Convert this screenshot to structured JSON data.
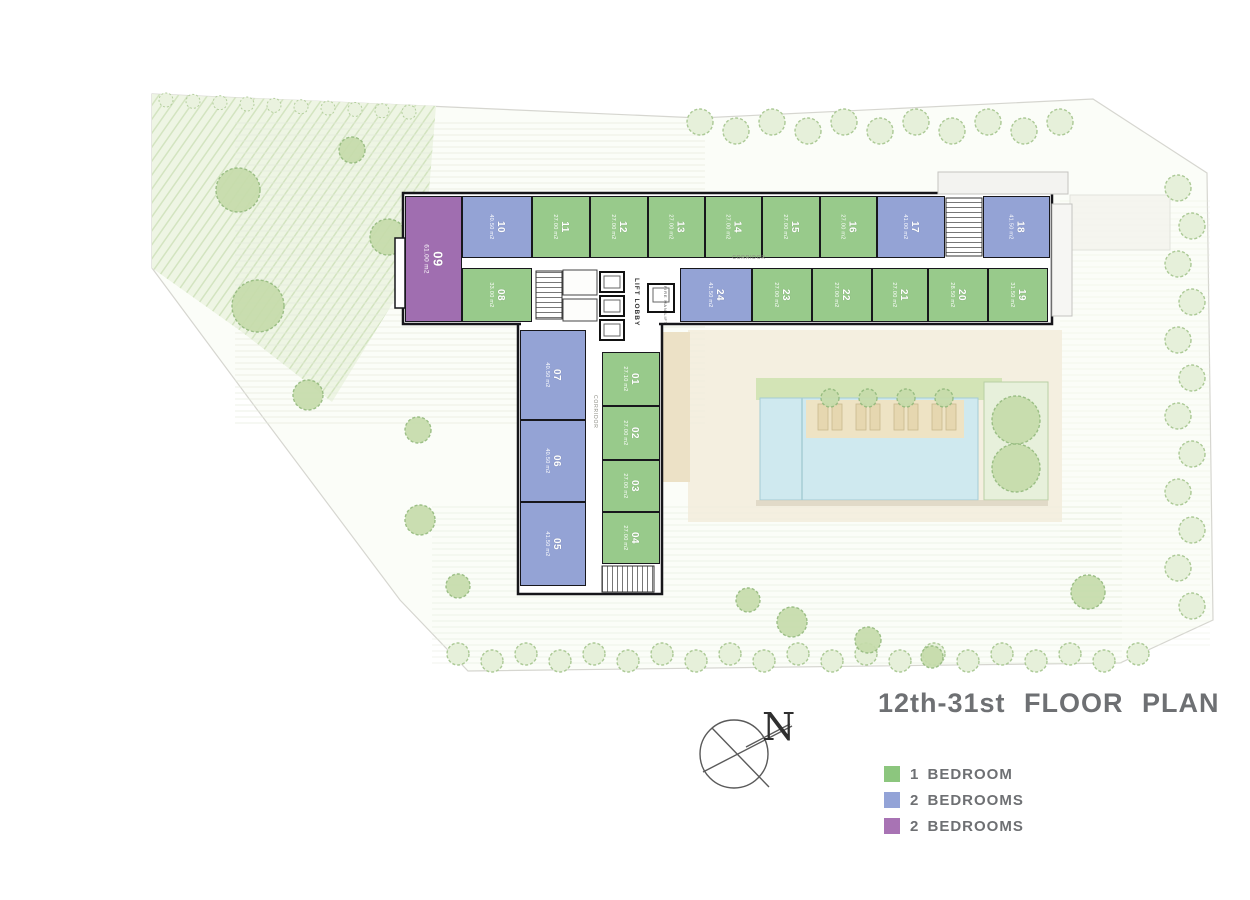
{
  "title": "12th-31st FLOOR PLAN",
  "compass": {
    "label": "N"
  },
  "legend": {
    "items": [
      {
        "label": "1 BEDROOM",
        "color": "#8cc67e",
        "type": "green"
      },
      {
        "label": "2 BEDROOMS",
        "color": "#93a3d7",
        "type": "blue"
      },
      {
        "label": "2 BEDROOMS",
        "color": "#a873b4",
        "type": "purple"
      }
    ]
  },
  "labels": {
    "corridor_top": "CORRIDOR",
    "corridor_wing": "CORRIDOR",
    "lift_lobby": "LIFT LOBBY",
    "fire_man_lift": "FIRE MAN LIFT"
  },
  "colors": {
    "green": "#98ca8b",
    "blue": "#94a3d5",
    "purple": "#a06eb0",
    "title_text": "#6e7073",
    "unit_label_text": "#ffffff"
  },
  "units": [
    {
      "number": "01",
      "area": "27.10 m2",
      "type": "green",
      "geom": {
        "x": 602,
        "y": 352,
        "w": 58,
        "h": 54
      }
    },
    {
      "number": "02",
      "area": "27.00 m2",
      "type": "green",
      "geom": {
        "x": 602,
        "y": 406,
        "w": 58,
        "h": 54
      }
    },
    {
      "number": "03",
      "area": "27.00 m2",
      "type": "green",
      "geom": {
        "x": 602,
        "y": 460,
        "w": 58,
        "h": 52
      }
    },
    {
      "number": "04",
      "area": "27.00 m2",
      "type": "green",
      "geom": {
        "x": 602,
        "y": 512,
        "w": 58,
        "h": 52
      }
    },
    {
      "number": "05",
      "area": "41.50 m2",
      "type": "blue",
      "geom": {
        "x": 520,
        "y": 502,
        "w": 66,
        "h": 84
      }
    },
    {
      "number": "06",
      "area": "40.50 m2",
      "type": "blue",
      "geom": {
        "x": 520,
        "y": 420,
        "w": 66,
        "h": 82
      }
    },
    {
      "number": "07",
      "area": "40.50 m2",
      "type": "blue",
      "geom": {
        "x": 520,
        "y": 330,
        "w": 66,
        "h": 90
      }
    },
    {
      "number": "08",
      "area": "33.00 m2",
      "type": "green",
      "geom": {
        "x": 462,
        "y": 268,
        "w": 70,
        "h": 54
      }
    },
    {
      "number": "09",
      "area": "61.00 m2",
      "type": "purple",
      "geom": {
        "x": 405,
        "y": 196,
        "w": 57,
        "h": 126
      }
    },
    {
      "number": "10",
      "area": "40.50 m2",
      "type": "blue",
      "geom": {
        "x": 462,
        "y": 196,
        "w": 70,
        "h": 62
      }
    },
    {
      "number": "11",
      "area": "27.00 m2",
      "type": "green",
      "geom": {
        "x": 532,
        "y": 196,
        "w": 58,
        "h": 62
      }
    },
    {
      "number": "12",
      "area": "27.00 m2",
      "type": "green",
      "geom": {
        "x": 590,
        "y": 196,
        "w": 58,
        "h": 62
      }
    },
    {
      "number": "13",
      "area": "27.00 m2",
      "type": "green",
      "geom": {
        "x": 648,
        "y": 196,
        "w": 57,
        "h": 62
      }
    },
    {
      "number": "14",
      "area": "27.00 m2",
      "type": "green",
      "geom": {
        "x": 705,
        "y": 196,
        "w": 57,
        "h": 62
      }
    },
    {
      "number": "15",
      "area": "27.00 m2",
      "type": "green",
      "geom": {
        "x": 762,
        "y": 196,
        "w": 58,
        "h": 62
      }
    },
    {
      "number": "16",
      "area": "27.00 m2",
      "type": "green",
      "geom": {
        "x": 820,
        "y": 196,
        "w": 57,
        "h": 62
      }
    },
    {
      "number": "17",
      "area": "41.00 m2",
      "type": "blue",
      "geom": {
        "x": 877,
        "y": 196,
        "w": 68,
        "h": 62
      }
    },
    {
      "number": "18",
      "area": "41.50 m2",
      "type": "blue",
      "geom": {
        "x": 983,
        "y": 196,
        "w": 67,
        "h": 62
      }
    },
    {
      "number": "19",
      "area": "31.50 m2",
      "type": "green",
      "geom": {
        "x": 988,
        "y": 268,
        "w": 60,
        "h": 54
      }
    },
    {
      "number": "20",
      "area": "28.50 m2",
      "type": "green",
      "geom": {
        "x": 928,
        "y": 268,
        "w": 60,
        "h": 54
      }
    },
    {
      "number": "21",
      "area": "27.00 m2",
      "type": "green",
      "geom": {
        "x": 872,
        "y": 268,
        "w": 56,
        "h": 54
      }
    },
    {
      "number": "22",
      "area": "27.00 m2",
      "type": "green",
      "geom": {
        "x": 812,
        "y": 268,
        "w": 60,
        "h": 54
      }
    },
    {
      "number": "23",
      "area": "27.00 m2",
      "type": "green",
      "geom": {
        "x": 752,
        "y": 268,
        "w": 60,
        "h": 54
      }
    },
    {
      "number": "24",
      "area": "41.50 m2",
      "type": "blue",
      "geom": {
        "x": 680,
        "y": 268,
        "w": 72,
        "h": 54
      }
    }
  ]
}
